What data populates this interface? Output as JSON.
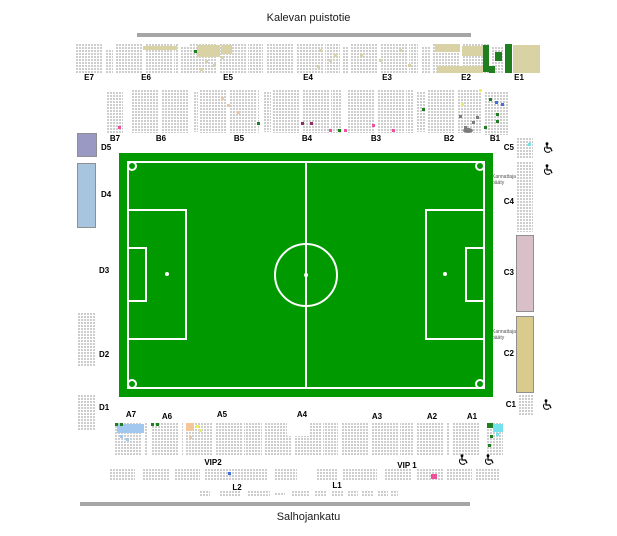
{
  "streets": {
    "top": "Kalevan puistotie",
    "bottom": "Salhojankatu"
  },
  "sections": {
    "e7": "E7",
    "e6": "E6",
    "e5": "E5",
    "e4": "E4",
    "e3": "E3",
    "e2": "E2",
    "e1": "E1",
    "b7": "B7",
    "b6": "B6",
    "b5": "B5",
    "b4": "B4",
    "b3": "B3",
    "b2": "B2",
    "b1": "B1",
    "c5": "C5",
    "c4": "C4",
    "c3": "C3",
    "c2": "C2",
    "c1": "C1",
    "d5": "D5",
    "d4": "D4",
    "d3": "D3",
    "d2": "D2",
    "d1": "D1",
    "a7": "A7",
    "a6": "A6",
    "a5": "A5",
    "a4": "A4",
    "a3": "A3",
    "a2": "A2",
    "a1": "A1",
    "vip2": "VIP2",
    "vip1": "VIP 1",
    "l2": "L2",
    "l1": "L1"
  },
  "notes": {
    "c4": "Kannattaja pääty",
    "c2": "Kannattaja pääty"
  },
  "icons": {
    "wheelchair": "wheelchair-icon"
  },
  "colors": {
    "street_bar": "#a6a6a6",
    "pitch_green": "#009a00",
    "pitch_line": "#ffffff",
    "seat_available": "#c9c9c9",
    "seat_sold_tan": "#d8d2a4",
    "seat_green": "#1f7f1f",
    "seat_light_blue": "#a3c8ef",
    "seat_cyan": "#74e3ee",
    "seat_blue": "#3f6fd8",
    "seat_pink": "#ef4f9b",
    "seat_purple": "#8e2f66",
    "seat_peach": "#f5c59b",
    "seat_yellow": "#eded6a",
    "seat_dark_gray": "#7c7c7c",
    "block_d5": "#9a99c4",
    "block_d4": "#a8c5e0",
    "block_c3": "#d9c0c8",
    "block_c2": "#d9cb8d",
    "block_border": "#8f8f8f",
    "label_color": "#000000"
  }
}
